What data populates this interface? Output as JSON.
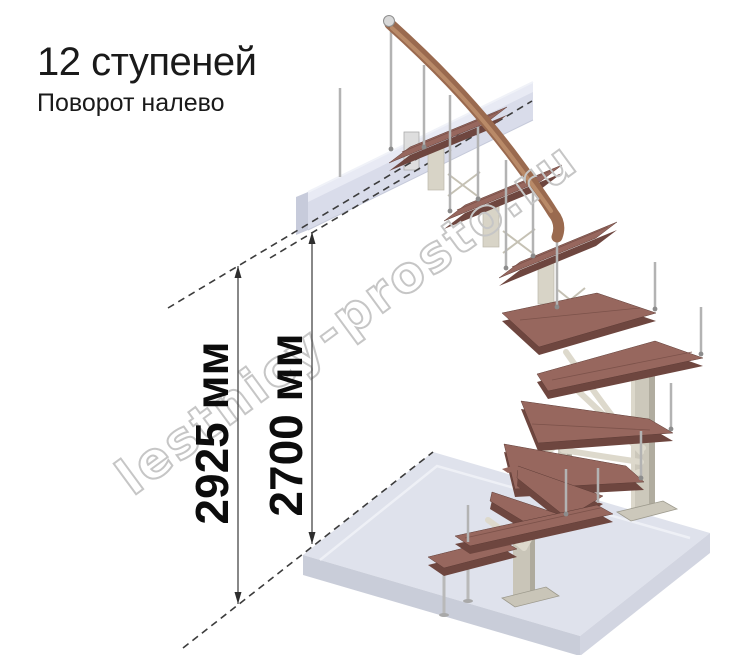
{
  "page": {
    "width": 743,
    "height": 655,
    "background": "#ffffff"
  },
  "header": {
    "title": "12 ступеней",
    "subtitle": "Поворот налево"
  },
  "dimensions": {
    "left": {
      "label": "2925 мм"
    },
    "right": {
      "label": "2700 мм"
    }
  },
  "watermark": {
    "text": "lestnicy-prosto.ru"
  },
  "staircase": {
    "steps_count": 12,
    "turn_direction": "налево",
    "description": "3D render: модульная лестница на 12 ступеней с поворотом налево, верхняя площадка и нижнее перекрытие",
    "colors": {
      "tread_top": "#97675e",
      "tread_edge": "#6e463f",
      "handrail": "#9a6a4f",
      "metal_baluster": "#b3b3b3",
      "support": "#ccc8bb",
      "floor_slab": "#dfe2ec",
      "landing_beam": "#d9dcea",
      "dimension_line": "#3a3a3a",
      "watermark_outline": "#c6c6c6",
      "text": "#1a1a1a"
    }
  }
}
